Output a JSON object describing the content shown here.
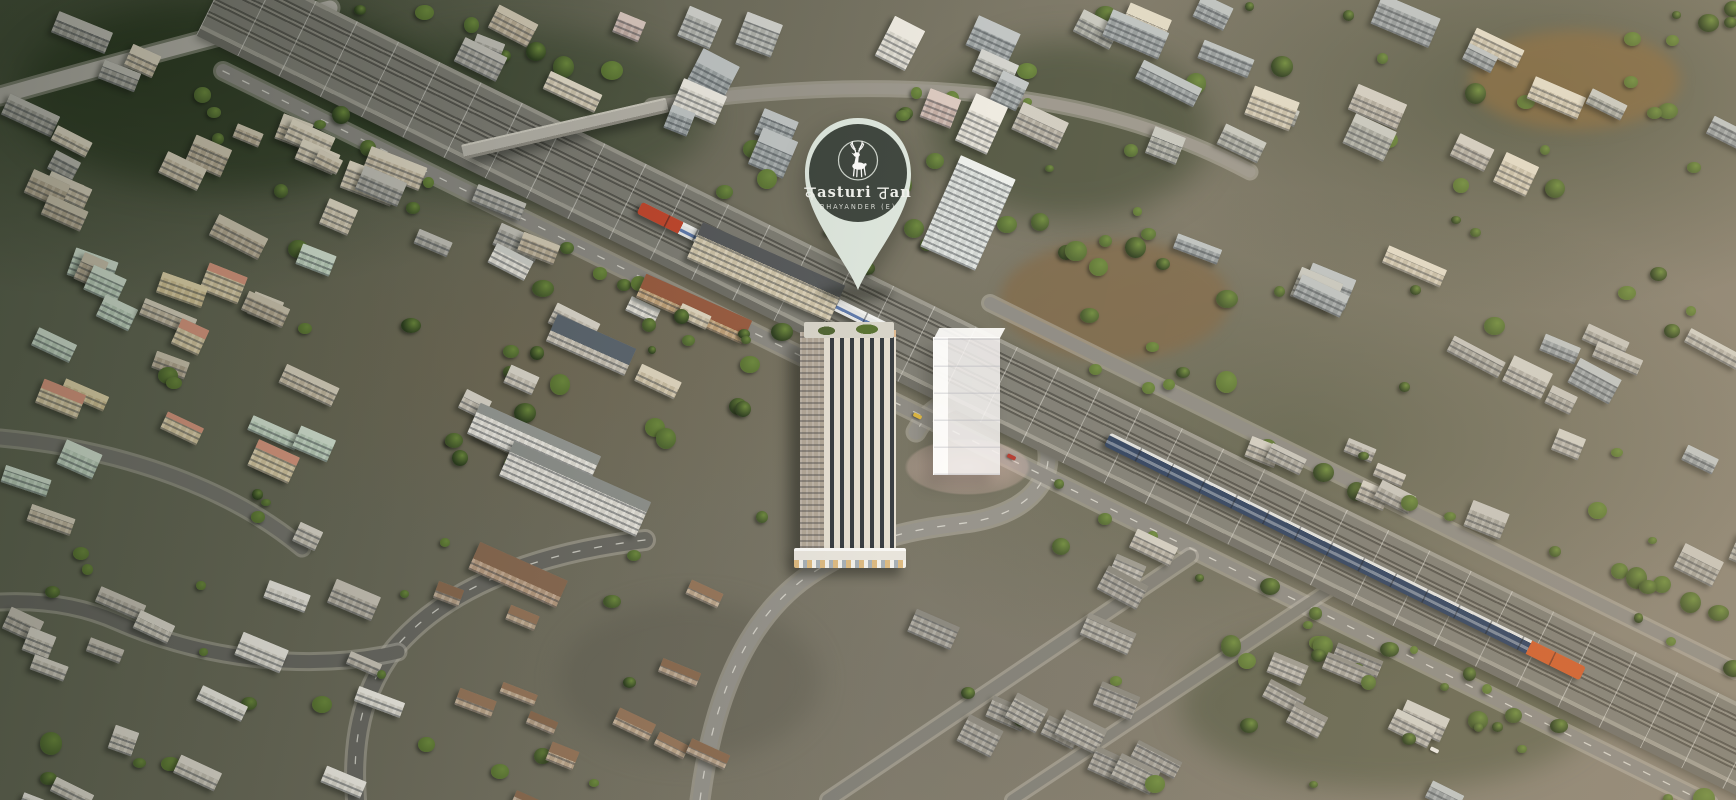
{
  "branding": {
    "name_display": "कasturi वan",
    "name_latin_mid": "asturi",
    "name_latin_end": "an",
    "subtitle": "BHAYANDER (E)",
    "colors": {
      "pin_fill": "#dfe9e1",
      "badge_fill": "#3a423c",
      "text": "#f3f5f1",
      "ring": "#cfd6cf"
    }
  },
  "scene": {
    "seed": 11,
    "palette": {
      "window": "rgba(42,48,56,0.42)",
      "trees": [
        "#2c3d1f",
        "#41552a",
        "#4e6630",
        "#5a7433"
      ],
      "tree_hi": "#6d8a3e"
    },
    "railway": {
      "x1": 250,
      "y1": 15,
      "x2": 1736,
      "y2": 748,
      "band": 84
    },
    "trains": [
      {
        "name": "suburban-train",
        "cx": 765,
        "cy": 269,
        "len": 280,
        "h": 13,
        "body": "#e9eaea",
        "roof": "#f4f5f4",
        "stripe": "#5d79ae",
        "stripe_top": 7,
        "head": "#c2452c",
        "headlen": 46,
        "head_side": "left",
        "gap": 30
      },
      {
        "name": "express-train",
        "cx": 1345,
        "cy": 556,
        "len": 530,
        "h": 15,
        "body": "#2e4160",
        "roof": "#dfe0de",
        "stripe": "rgba(205,210,215,0.45)",
        "stripe_top": 8,
        "head": "#cd5c2b",
        "headlen": 60,
        "head_side": "right",
        "gap": 34
      }
    ],
    "flyover": {
      "cx": 565,
      "cy": 128,
      "len": 210,
      "h": 15,
      "angle": -13,
      "deck": "#b6b3aa"
    },
    "roads": [
      {
        "d": "M 645 540 C 520 555 440 595 395 648 C 360 692 352 745 356 800",
        "w": 16,
        "c": "#6b6a64",
        "dash": true
      },
      {
        "d": "M 398 652 C 310 672 205 660 118 622 C 80 605 40 600 0 602",
        "w": 13,
        "c": "#6b6a64",
        "dash": false
      },
      {
        "d": "M 700 800 C 712 706 742 622 808 576 C 872 532 930 528 972 522 C 1030 512 1056 478 1046 442 C 1038 414 1010 398 982 396 C 950 395 928 410 916 432",
        "w": 15,
        "c": "#92908a",
        "dash": true
      },
      {
        "d": "M 223 71 L 1709 804",
        "w": 14,
        "c": "#8b8983",
        "dash": true
      },
      {
        "d": "M 990 303 L 1736 671",
        "w": 12,
        "c": "#8b8983",
        "dash": false
      },
      {
        "d": "M 0 96 C 120 62 240 30 330 8",
        "w": 15,
        "c": "#b4b1a9",
        "dash": false
      },
      {
        "d": "M 652 106 C 770 88 880 84 980 94 C 1090 105 1175 132 1250 172",
        "w": 11,
        "c": "#9a968d",
        "dash": false
      },
      {
        "d": "M 828 800 L 1190 556",
        "w": 12,
        "c": "#7e7d76",
        "dash": false
      },
      {
        "d": "M 1012 800 L 1336 585",
        "w": 10,
        "c": "#7e7d76",
        "dash": false
      },
      {
        "d": "M 0 438 C 130 450 235 492 302 548",
        "w": 13,
        "c": "#77766f",
        "dash": false
      }
    ],
    "patches": [
      {
        "x": 1000,
        "y": 240,
        "w": 230,
        "h": 120,
        "c": "rgba(125,102,71,0.80)",
        "b": 6
      },
      {
        "x": 1470,
        "y": 30,
        "w": 210,
        "h": 100,
        "c": "rgba(134,105,63,0.75)",
        "b": 7
      },
      {
        "x": 20,
        "y": 0,
        "w": 420,
        "h": 190,
        "c": "rgba(30,46,22,0.50)",
        "b": 16
      },
      {
        "x": 930,
        "y": 40,
        "w": 280,
        "h": 180,
        "c": "rgba(36,52,27,0.45)",
        "b": 16
      },
      {
        "x": 330,
        "y": 30,
        "w": 380,
        "h": 170,
        "c": "rgba(38,54,29,0.40)",
        "b": 16
      },
      {
        "x": 560,
        "y": 600,
        "w": 260,
        "h": 160,
        "c": "rgba(95,94,82,0.50)",
        "b": 12
      },
      {
        "x": 1180,
        "y": 620,
        "w": 420,
        "h": 170,
        "c": "rgba(52,64,38,0.40)",
        "b": 14
      }
    ],
    "zones": [
      {
        "x": 0,
        "y": 0,
        "w": 560,
        "h": 240,
        "n": 30,
        "angle": 24,
        "wmin": 26,
        "wmax": 60,
        "hmin": 14,
        "hmax": 30,
        "walls": [
          [
            "#cfc3ab",
            "#ddd5c2"
          ],
          [
            "#bfb29a",
            "#d2c9b4"
          ],
          [
            "#a8a69e",
            "#c2c0b8"
          ],
          [
            "#d8cdb6",
            "#e4dcc9"
          ]
        ]
      },
      {
        "x": 560,
        "y": 0,
        "w": 450,
        "h": 170,
        "n": 14,
        "angle": 24,
        "wmin": 24,
        "wmax": 48,
        "hmin": 22,
        "hmax": 52,
        "walls": [
          [
            "#b7b9b4",
            "#d2d3cf"
          ],
          [
            "#e2dfd6",
            "#efece4"
          ],
          [
            "#9fa6a8",
            "#c0c5c6"
          ],
          [
            "#cbb5ad",
            "#dccac2"
          ]
        ]
      },
      {
        "x": 1010,
        "y": 0,
        "w": 726,
        "h": 300,
        "n": 26,
        "angle": 24,
        "wmin": 28,
        "wmax": 68,
        "hmin": 16,
        "hmax": 34,
        "walls": [
          [
            "#9aa1a3",
            "#bcc2c2"
          ],
          [
            "#a8aaa2",
            "#c6c7c0"
          ],
          [
            "#b5b0a4",
            "#d0ccc2"
          ],
          [
            "#cfc6b0",
            "#e0d9c6"
          ]
        ]
      },
      {
        "x": 0,
        "y": 245,
        "w": 430,
        "h": 275,
        "n": 24,
        "angle": 22,
        "wmin": 26,
        "wmax": 58,
        "hmin": 16,
        "hmax": 30,
        "walls": [
          [
            "#cfc3ab",
            "#ddd5c2"
          ],
          [
            "#e0cfa0",
            "#e8dab0"
          ],
          [
            "#e3d3ac",
            "#dd9a82"
          ],
          [
            "#c9dcc8",
            "#d8e6d6"
          ],
          [
            "#bfb29a",
            "#d2c9b4"
          ]
        ]
      },
      {
        "x": 440,
        "y": 250,
        "w": 250,
        "h": 180,
        "n": 8,
        "angle": 24,
        "wmin": 24,
        "wmax": 50,
        "hmin": 14,
        "hmax": 26,
        "walls": [
          [
            "#d6c9ae",
            "#e2d8c2"
          ],
          [
            "#e8e5dc",
            "#cfd0cb"
          ],
          [
            "#cfc8bb",
            "#ddd8cd"
          ]
        ]
      },
      {
        "x": 1390,
        "y": 310,
        "w": 346,
        "h": 480,
        "n": 16,
        "angle": 25,
        "wmin": 28,
        "wmax": 60,
        "hmin": 16,
        "hmax": 30,
        "walls": [
          [
            "#a9a79e",
            "#c4c2ba"
          ],
          [
            "#b4b2a9",
            "#ceccC3"
          ],
          [
            "#9aa1a3",
            "#bcc2c2"
          ]
        ]
      },
      {
        "x": 840,
        "y": 540,
        "w": 520,
        "h": 250,
        "n": 18,
        "angle": 25,
        "wmin": 30,
        "wmax": 52,
        "hmin": 18,
        "hmax": 30,
        "roof_pct": 22,
        "walls": [
          [
            "#aba89f",
            "#908e86"
          ],
          [
            "#b6b3aa",
            "#9a988f"
          ],
          [
            "#a29f97",
            "#87857d"
          ]
        ]
      },
      {
        "x": 0,
        "y": 525,
        "w": 370,
        "h": 275,
        "n": 18,
        "angle": 23,
        "wmin": 24,
        "wmax": 52,
        "hmin": 14,
        "hmax": 26,
        "walls": [
          [
            "#cfc9bc",
            "#dfdacf"
          ],
          [
            "#b9b3a6",
            "#ccc6ba"
          ],
          [
            "#e4e0d6",
            "#efece4"
          ]
        ]
      },
      {
        "x": 380,
        "y": 565,
        "w": 310,
        "h": 235,
        "n": 12,
        "angle": 24,
        "wmin": 24,
        "wmax": 42,
        "hmin": 12,
        "hmax": 20,
        "roof_pct": 55,
        "walls": [
          [
            "#baa48c",
            "#8a6a50"
          ],
          [
            "#c2ab90",
            "#96755a"
          ]
        ]
      },
      {
        "x": 1060,
        "y": 430,
        "w": 330,
        "h": 120,
        "n": 7,
        "angle": 25,
        "wmin": 26,
        "wmax": 48,
        "hmin": 14,
        "hmax": 24,
        "walls": [
          [
            "#b5b0a4",
            "#d0ccc2"
          ],
          [
            "#aba89f",
            "#c5c3bb"
          ]
        ]
      }
    ],
    "landmarks": [
      {
        "name": "school-block-a",
        "x": 468,
        "y": 428,
        "w": 132,
        "h": 34,
        "angle": 24,
        "wall": "#edeae2",
        "roof": "#979a96",
        "roof_pct": 30
      },
      {
        "name": "school-block-b",
        "x": 500,
        "y": 470,
        "w": 150,
        "h": 38,
        "angle": 24,
        "wall": "#e9e6de",
        "roof": "#8f928e",
        "roof_pct": 30
      },
      {
        "name": "colonnade-building",
        "x": 688,
        "y": 252,
        "w": 156,
        "h": 40,
        "angle": 24,
        "wall": "#d9cdb2",
        "roof": "#54575a",
        "roof_pct": 34
      },
      {
        "name": "red-roof-sheds",
        "x": 636,
        "y": 296,
        "w": 116,
        "h": 26,
        "angle": 24,
        "wall": "#c9a97f",
        "roof": "#9a5b40",
        "roof_pct": 60
      },
      {
        "name": "blue-roof-shed",
        "x": 548,
        "y": 330,
        "w": 86,
        "h": 30,
        "angle": 24,
        "wall": "#cfc8bb",
        "roof": "#5c6670",
        "roof_pct": 60
      },
      {
        "name": "white-glass-tower",
        "x": 938,
        "y": 163,
        "w": 60,
        "h": 100,
        "angle": 24,
        "wall": "#dce1df",
        "roof": "#edf0ee",
        "roof_pct": 8
      },
      {
        "name": "brown-shed",
        "x": 470,
        "y": 560,
        "w": 96,
        "h": 30,
        "angle": 24,
        "wall": "#bfa287",
        "roof": "#8a6a52",
        "roof_pct": 60
      }
    ],
    "tree_belts": [
      {
        "x": 1010,
        "y": 0,
        "w": 726,
        "h": 310,
        "n": 40
      },
      {
        "x": 430,
        "y": 210,
        "w": 430,
        "h": 350,
        "n": 24
      },
      {
        "x": 850,
        "y": 500,
        "w": 680,
        "h": 290,
        "n": 24
      },
      {
        "x": 0,
        "y": 0,
        "w": 560,
        "h": 530,
        "n": 26
      },
      {
        "x": 0,
        "y": 530,
        "w": 700,
        "h": 270,
        "n": 20
      },
      {
        "x": 1390,
        "y": 300,
        "w": 346,
        "h": 500,
        "n": 22
      },
      {
        "x": 860,
        "y": 60,
        "w": 300,
        "h": 240,
        "n": 18
      }
    ],
    "rail_trees": {
      "n": 60,
      "omin": 48,
      "omax": 118
    },
    "skip_rects": [
      {
        "x": 780,
        "y": 278,
        "w": 255,
        "h": 310
      }
    ],
    "cars": [
      {
        "x": 1007,
        "y": 455,
        "c": "#b3362c"
      },
      {
        "x": 1430,
        "y": 748,
        "c": "#e8e6e0"
      },
      {
        "x": 913,
        "y": 414,
        "c": "#d8b23c"
      }
    ]
  }
}
